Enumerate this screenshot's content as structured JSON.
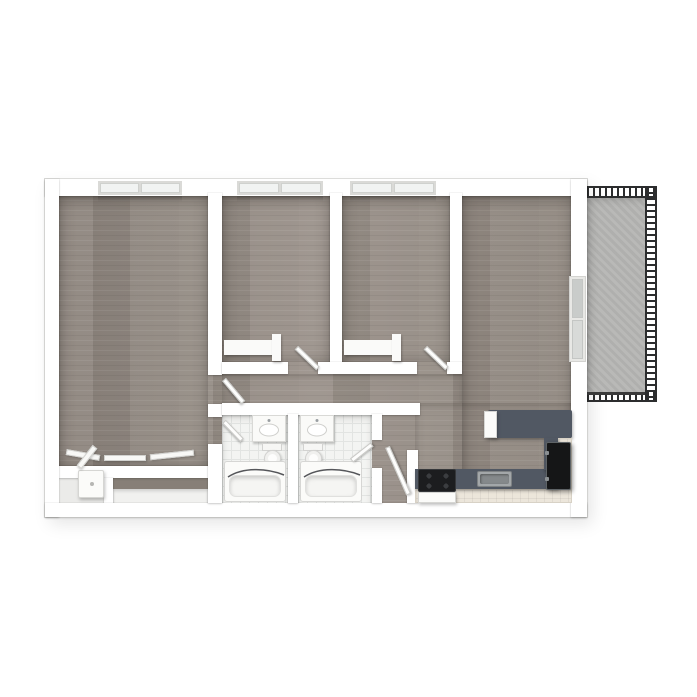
{
  "scene": {
    "kind": "3d-floor-plan-top-down-render",
    "description": "Rendered apartment floor plan: three carpeted/wood rooms with windows, living-kitchen area, two bathrooms, closets and a railed balcony",
    "background": "#ffffff"
  },
  "palette": {
    "wall": "#ffffff",
    "wall_edge": "#e8e8e6",
    "wood_floor": "#958c84",
    "balcony_concrete": "#b5b5b3",
    "bathroom_tile": "#f3f4f2",
    "countertop": "#515863",
    "cabinet_front": "#ece6db",
    "appliance_black": "#1c1d1f",
    "railing": "#2c2d2e",
    "fixture_white": "#fbfbf9"
  },
  "rooms": [
    {
      "id": "master-bedroom",
      "name": "master bedroom",
      "floor": "wood",
      "window": "top"
    },
    {
      "id": "bedroom-2",
      "name": "bedroom 2",
      "floor": "wood",
      "window": "top"
    },
    {
      "id": "bedroom-3",
      "name": "bedroom 3",
      "floor": "wood",
      "window": "top"
    },
    {
      "id": "living-kitchen",
      "name": "living room and kitchen",
      "floor": "wood",
      "window": "right"
    },
    {
      "id": "bathroom-left",
      "name": "bathroom 1",
      "floor": "tile"
    },
    {
      "id": "bathroom-right",
      "name": "bathroom 2",
      "floor": "tile"
    },
    {
      "id": "hallway",
      "name": "hallway",
      "floor": "wood"
    },
    {
      "id": "entry-nook",
      "name": "nook",
      "floor": "wood"
    },
    {
      "id": "balcony",
      "name": "balcony",
      "floor": "concrete",
      "railing": true
    }
  ],
  "windows": [
    {
      "id": "window-master",
      "wall": "top",
      "panes": 2
    },
    {
      "id": "window-bedroom-2",
      "wall": "top",
      "panes": 2
    },
    {
      "id": "window-bedroom-3",
      "wall": "top",
      "panes": 2
    },
    {
      "id": "window-living",
      "wall": "right",
      "panes": 2
    }
  ],
  "doors": [
    {
      "id": "door-master-hall",
      "state": "open"
    },
    {
      "id": "door-master-bath",
      "state": "open"
    },
    {
      "id": "door-bedroom-2",
      "state": "open"
    },
    {
      "id": "door-bedroom-3",
      "state": "open"
    },
    {
      "id": "door-bathroom-right",
      "state": "open"
    },
    {
      "id": "door-nook",
      "state": "open"
    }
  ],
  "fixtures": [
    {
      "id": "vanity-left",
      "name": "bathroom vanity with sink"
    },
    {
      "id": "vanity-right",
      "name": "bathroom vanity with sink"
    },
    {
      "id": "toilet-left",
      "name": "toilet"
    },
    {
      "id": "toilet-right",
      "name": "toilet"
    },
    {
      "id": "bathtub-left",
      "name": "bathtub with shower curtain"
    },
    {
      "id": "bathtub-right",
      "name": "bathtub with shower curtain"
    },
    {
      "id": "range",
      "name": "kitchen range with four burners"
    },
    {
      "id": "kitchen-sink",
      "name": "kitchen sink"
    },
    {
      "id": "refrigerator",
      "name": "refrigerator"
    },
    {
      "id": "breakfast-bar",
      "name": "breakfast bar counter"
    },
    {
      "id": "kitchen-counter",
      "name": "L-shaped kitchen counter"
    },
    {
      "id": "water-heater",
      "name": "water heater in closet"
    },
    {
      "id": "closet-shelf-bedroom-2",
      "name": "closet shelf"
    },
    {
      "id": "closet-shelf-bedroom-3",
      "name": "closet shelf"
    },
    {
      "id": "wardrobe-row",
      "name": "bottom wall closets with open doors"
    }
  ]
}
